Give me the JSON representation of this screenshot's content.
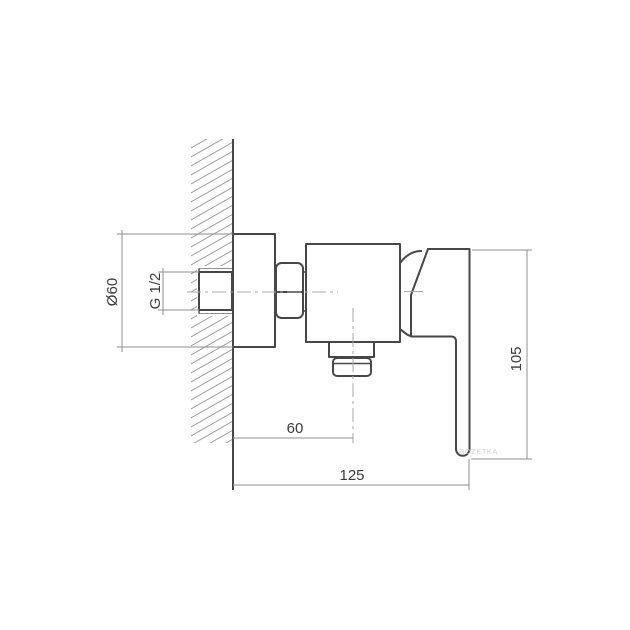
{
  "dimensions": {
    "flange_diameter": "Ø60",
    "thread_size": "G 1/2",
    "outlet_offset": "60",
    "overall_depth": "125",
    "overall_height": "105"
  },
  "watermark": "ROZETKA",
  "colors": {
    "outline": "#474747",
    "dimension": "#8f8f8f",
    "centerline": "#a9a9a9",
    "hatch": "#9e9e9e",
    "label": "#3a3a3a",
    "watermark": "#c9c9c9",
    "background": "#ffffff"
  }
}
